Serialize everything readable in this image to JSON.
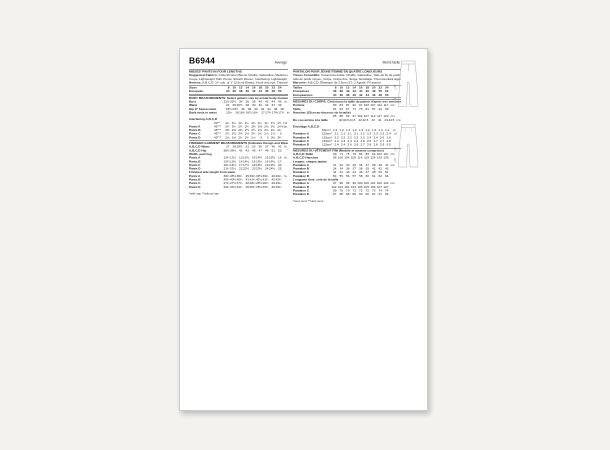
{
  "colors": {
    "canvas_bg": "#f3f2ef",
    "page_bg": "#ffffff",
    "text": "#1c1c1c",
    "line_art": "#90959a"
  },
  "header": {
    "code": "B6944",
    "difficulty_en": "Average",
    "difficulty_fr": "Moins facile"
  },
  "columns": {
    "english": [
      {
        "h": "MISSES' PANTS IN FOUR LENGTHS"
      },
      {
        "b": "Suggested Fabrics:",
        "t": " Cotton/Cotton Blend, Challis, Gabardine, Medium-weight Linen,"
      },
      {
        "t": "Crepe, Lightweight Twill, Ponte, Stretch Woven. Interfacing: Lightweight fusible."
      },
      {
        "b": "Notions:",
        "t": " A,B,C,D: 1¼ yds. of 1\" (2.5cm) Elastic, Hook and eye, Thread to match."
      },
      {
        "r": 1
      },
      {
        "l": "Sizes",
        "bold": true,
        "v": [
          "8",
          "10",
          "12",
          "14",
          "16",
          "18",
          "20",
          "22",
          "24"
        ],
        "u": ""
      },
      {
        "l": "European",
        "bold": true,
        "v": [
          "34",
          "36",
          "38",
          "40",
          "42",
          "44",
          "46",
          "48",
          "50"
        ],
        "u": ""
      },
      {
        "r": 1
      },
      {
        "h": "BODY MEASUREMENTS: Select pattern size by actual body measurements."
      },
      {
        "l": "Bust",
        "v": [
          "31½",
          "32½",
          "34",
          "36",
          "38",
          "40",
          "42",
          "44",
          "46"
        ],
        "u": "In."
      },
      {
        "l": "Waist",
        "v": [
          "24",
          "25",
          "26½",
          "28",
          "30",
          "32",
          "34",
          "37",
          "39"
        ],
        "u": ""
      },
      {
        "l": "Hip 9\" below waist",
        "v": [
          "33½",
          "34½",
          "36",
          "38",
          "40",
          "42",
          "44",
          "46",
          "48"
        ],
        "u": ""
      },
      {
        "l": "Back neck to waist",
        "v": [
          "15¾",
          "16",
          "16¼",
          "16½",
          "16¾",
          "17",
          "17¼",
          "17⅜",
          "17½"
        ],
        "u": "In."
      },
      {
        "g": 6
      },
      {
        "s": "Interfacing A,B,C,D"
      },
      {
        "l": "",
        "p": "20\"*",
        "v": [
          "1¼",
          "1¼",
          "1¼",
          "1¼",
          "1¼",
          "1¼",
          "1¼",
          "1½",
          "1½"
        ],
        "u": "Yd."
      },
      {
        "l": "Pants A",
        "p": "45\"**",
        "v": [
          "2¼",
          "2¼",
          "2¼",
          "2¼",
          "2⅜",
          "2⅜",
          "2½",
          "2½",
          "2⅝"
        ],
        "u": "Yds."
      },
      {
        "l": "Pants B",
        "p": "45\"**",
        "v": [
          "2⅜",
          "2⅜",
          "2⅜",
          "2½",
          "2½",
          "2⅝",
          "2⅝",
          "2¾",
          "2¾"
        ],
        "u": ""
      },
      {
        "l": "Pants C",
        "p": "45\"**",
        "v": [
          "2½",
          "2½",
          "2⅝",
          "2⅝",
          "2¾",
          "2¾",
          "2⅞",
          "2⅞",
          "3"
        ],
        "u": ""
      },
      {
        "l": "Pants D",
        "p": "45\"**",
        "v": [
          "2⅝",
          "2⅝",
          "2¾",
          "2¾",
          "2⅞",
          "3",
          "3",
          "3⅛",
          "3¼"
        ],
        "u": ""
      },
      {
        "h": "FINISHED GARMENT MEASUREMENTS (Indicates Design and Wearing Ease)"
      },
      {
        "l": "A,B,C,D Waist",
        "v": [
          "27",
          "28",
          "29½",
          "31",
          "33",
          "35",
          "37",
          "40",
          "42"
        ],
        "u": "In."
      },
      {
        "l": "A,B,C,D Hip",
        "v": [
          "38½",
          "39½",
          "41",
          "43",
          "45",
          "47",
          "49",
          "51",
          "53"
        ],
        "u": "\""
      },
      {
        "s": "Width, each leg"
      },
      {
        "l": "Pants A",
        "v": [
          "12¼",
          "12½",
          "13",
          "13½",
          "14",
          "14½",
          "15",
          "15½",
          "16"
        ],
        "u": "In."
      },
      {
        "l": "Pants B",
        "v": [
          "13¼",
          "13½",
          "14",
          "14½",
          "15",
          "15½",
          "16",
          "16½",
          "17"
        ],
        "u": ""
      },
      {
        "l": "Pants C",
        "v": [
          "16¼",
          "16½",
          "17",
          "17½",
          "18",
          "18½",
          "19",
          "19½",
          "20"
        ],
        "u": ""
      },
      {
        "l": "Pants D",
        "v": [
          "21¼",
          "21½",
          "22",
          "22½",
          "23",
          "23½",
          "24",
          "24½",
          "25"
        ],
        "u": ""
      },
      {
        "s": "Finished side length from waist"
      },
      {
        "l": "Pants A",
        "v": [
          "38¼",
          "38½",
          "38¾",
          "39",
          "39¼",
          "39½",
          "39¾",
          "40",
          "40¼"
        ],
        "u": "In."
      },
      {
        "l": "Pants B",
        "v": [
          "40¼",
          "40½",
          "40¾",
          "41",
          "41¼",
          "41½",
          "41¾",
          "42",
          "42¼"
        ],
        "u": ""
      },
      {
        "l": "Pants C",
        "v": [
          "27¼",
          "27½",
          "27¾",
          "28",
          "28¼",
          "28½",
          "28¾",
          "29",
          "29¼"
        ],
        "u": ""
      },
      {
        "l": "Pants D",
        "v": [
          "34¼",
          "34½",
          "34¾",
          "35",
          "35¼",
          "35½",
          "35¾",
          "36",
          "36¼"
        ],
        "u": ""
      },
      {
        "f": "*with nap   **without nap"
      }
    ],
    "french": [
      {
        "h": "PANTALON POUR JEUNE FEMME EN QUATRE LONGUEURS"
      },
      {
        "b": "Tissus Conseillés:",
        "t": " Coton/cotonnade, Challis, Gabardine, Toile de lin de poids moyen, Mélange de"
      },
      {
        "t": "toile de poids moyen, Crêpe, Crêpe fine, Serge. Entoilage: Thermocollant léger."
      },
      {
        "b": "Mercerie:",
        "t": " A,B,C,D: Élastique de 2.5cm (1\"), 1 Agrafe, Fil assorti."
      },
      {
        "r": 1
      },
      {
        "l": "Tailles",
        "bold": true,
        "v": [
          "8",
          "10",
          "12",
          "14",
          "16",
          "18",
          "20",
          "22",
          "24"
        ],
        "u": ""
      },
      {
        "l": "Françaises",
        "bold": true,
        "v": [
          "36",
          "38",
          "40",
          "42",
          "44",
          "46",
          "48",
          "50",
          "52"
        ],
        "u": ""
      },
      {
        "l": "Européennes",
        "bold": true,
        "v": [
          "34",
          "36",
          "38",
          "40",
          "42",
          "44",
          "46",
          "48",
          "50"
        ],
        "u": ""
      },
      {
        "r": 1
      },
      {
        "h": "MESURES DU CORPS: Choisissez la taille du patron d'après vos mesures du corps."
      },
      {
        "l": "Poitrine",
        "v": [
          "80",
          "83",
          "87",
          "92",
          "97",
          "102",
          "107",
          "112",
          "117"
        ],
        "u": "cm"
      },
      {
        "l": "Taille",
        "v": [
          "61",
          "64",
          "67",
          "71",
          "76",
          "81",
          "87",
          "94",
          "99"
        ],
        "u": ""
      },
      {
        "s": "Hanches (23cm au-dessous de la taille)"
      },
      {
        "l": "",
        "v": [
          "85",
          "88",
          "92",
          "97",
          "102",
          "107",
          "112",
          "117",
          "122"
        ],
        "u": "cm"
      },
      {
        "l": "Du cou arrière à la taille",
        "v": [
          "40",
          "40.5",
          "41.5",
          "42",
          "42.5",
          "43",
          "44",
          "44",
          "44.5"
        ],
        "u": "cm"
      },
      {
        "g": 6
      },
      {
        "s": "Entoilage A,B,C,D"
      },
      {
        "l": "",
        "p": "50cm*",
        "v": [
          "1.2",
          "1.2",
          "1.2",
          "1.2",
          "1.2",
          "1.2",
          "1.2",
          "1.4",
          "1.4"
        ],
        "u": "m"
      },
      {
        "l": "Pantalon A",
        "p": "115cm*",
        "v": [
          "2.1",
          "2.1",
          "2.1",
          "2.1",
          "2.2",
          "2.2",
          "2.3",
          "2.3",
          "2.4"
        ],
        "u": "m"
      },
      {
        "l": "Pantalon B",
        "p": "115cm*",
        "v": [
          "2.2",
          "2.2",
          "2.2",
          "2.3",
          "2.3",
          "2.4",
          "2.4",
          "2.6",
          "2.6"
        ],
        "u": ""
      },
      {
        "l": "Pantalon C",
        "p": "115cm*",
        "v": [
          "2.3",
          "2.3",
          "2.4",
          "2.4",
          "2.6",
          "2.6",
          "2.7",
          "2.7",
          "2.8"
        ],
        "u": ""
      },
      {
        "l": "Pantalon D",
        "p": "115cm*",
        "v": [
          "2.4",
          "2.4",
          "2.6",
          "2.6",
          "2.7",
          "2.8",
          "2.8",
          "2.9",
          "3.0"
        ],
        "u": ""
      },
      {
        "h": "MESURES DU VÊTEMENT FINI (Modèle et aisance comprises)"
      },
      {
        "l": "A,B,C,D Taille",
        "v": [
          "69",
          "71",
          "75",
          "79",
          "84",
          "89",
          "94",
          "102",
          "107"
        ],
        "u": "cm"
      },
      {
        "l": "A,B,C,D Hanches",
        "v": [
          "98",
          "100",
          "104",
          "109",
          "114",
          "119",
          "124",
          "130",
          "135"
        ],
        "u": ""
      },
      {
        "s": "Largeur, chaque jambe"
      },
      {
        "l": "Pantalon A",
        "v": [
          "31",
          "32",
          "33",
          "34",
          "36",
          "37",
          "38",
          "39",
          "41"
        ],
        "u": "cm"
      },
      {
        "l": "Pantalon B",
        "v": [
          "34",
          "34",
          "36",
          "37",
          "38",
          "39",
          "41",
          "42",
          "43"
        ],
        "u": ""
      },
      {
        "l": "Pantalon C",
        "v": [
          "41",
          "42",
          "43",
          "44",
          "46",
          "47",
          "48",
          "50",
          "51"
        ],
        "u": ""
      },
      {
        "l": "Pantalon D",
        "v": [
          "54",
          "55",
          "56",
          "57",
          "58",
          "60",
          "61",
          "62",
          "64"
        ],
        "u": ""
      },
      {
        "s": "Longueur finie, côté de la taille"
      },
      {
        "l": "Pantalon A",
        "v": [
          "97",
          "98",
          "98",
          "99",
          "100",
          "100",
          "101",
          "102",
          "102"
        ],
        "u": "cm"
      },
      {
        "l": "Pantalon B",
        "v": [
          "102",
          "103",
          "104",
          "104",
          "105",
          "105",
          "106",
          "107",
          "107"
        ],
        "u": ""
      },
      {
        "l": "Pantalon C",
        "v": [
          "69",
          "70",
          "70",
          "71",
          "72",
          "72",
          "73",
          "74",
          "74"
        ],
        "u": ""
      },
      {
        "l": "Pantalon D",
        "v": [
          "87",
          "88",
          "88",
          "89",
          "90",
          "90",
          "91",
          "91",
          "92"
        ],
        "u": ""
      },
      {
        "f": "*avec sens   **sans sens"
      }
    ]
  },
  "illustrations": [
    {
      "name": "pants-front-view",
      "markers": [
        "A",
        "B"
      ]
    },
    {
      "name": "pants-back-view",
      "markers": [
        "C",
        "D"
      ]
    }
  ]
}
